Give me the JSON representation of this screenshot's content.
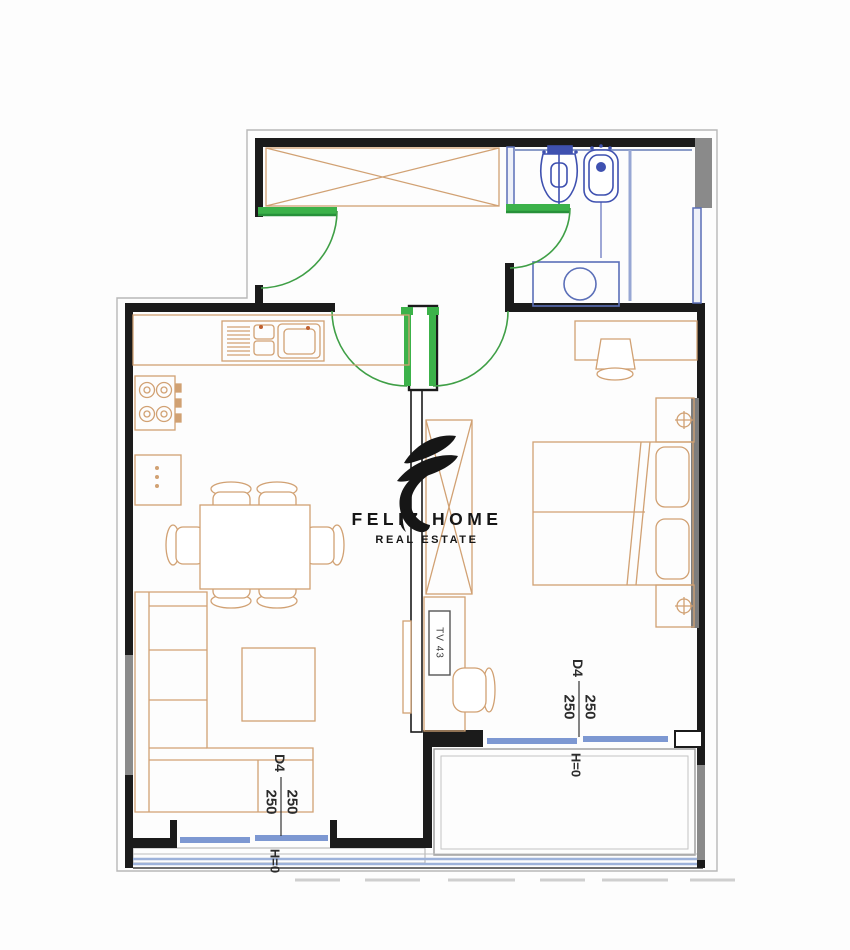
{
  "logo": {
    "brand": "FELIZ HOME",
    "tagline": "REAL ESTATE",
    "color": "#161616"
  },
  "dims": {
    "living": {
      "code": "D4",
      "left": "250",
      "right": "250",
      "height": "H=0"
    },
    "bedroom": {
      "code": "D4",
      "left": "250",
      "right": "250",
      "height": "H=0"
    }
  },
  "furniture": {
    "tv_label": "TV 43"
  },
  "colors": {
    "wall": "#1b1b1b",
    "furniture_line": "#d1a173",
    "door_green": "#3cb24a",
    "plumbing_blue": "#3f51b0",
    "bath_wall_blue": "#5b6fb8",
    "window_glass_blue": "#7d98d2",
    "window_gray": "#8a8a8a",
    "outline_gray": "#b8b8b8"
  }
}
